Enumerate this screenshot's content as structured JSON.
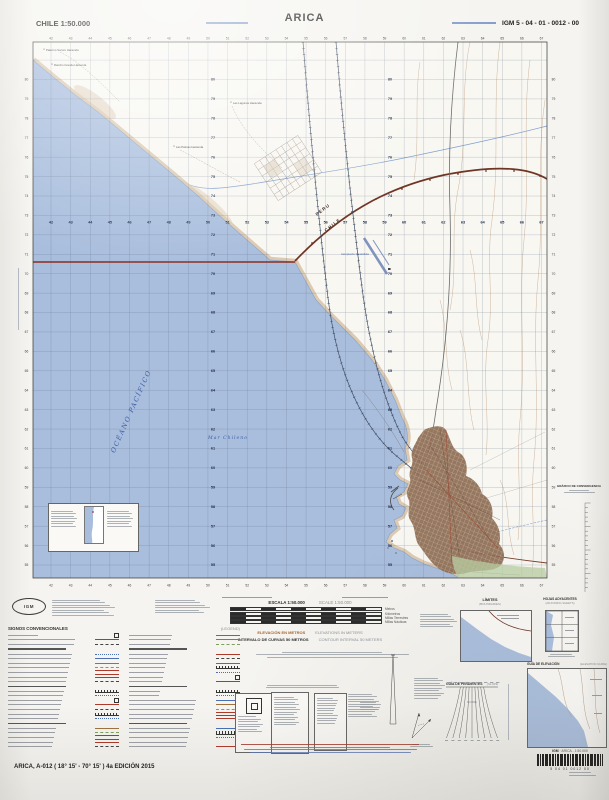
{
  "header": {
    "country_scale": "CHILE  1:50.000",
    "title": "ARICA",
    "sheet_code": "IGM 5 - 04 - 01 - 0012 - 00"
  },
  "map": {
    "labels": {
      "ocean": "OCÉANO   PACÍFICO",
      "sea": "Mar  Chileno",
      "peru": "PERU",
      "chile": "CHILE",
      "airport": "Aeropuerto Chacalluta"
    },
    "haciendas": [
      "Palermo Socoro Hacienda",
      "Rancho Grande Hacienda",
      "Las Lagunas Hacienda",
      "Las Palmas Hacienda"
    ],
    "grid": {
      "eastings": [
        42,
        43,
        44,
        45,
        46,
        47,
        48,
        49,
        50,
        51,
        52,
        53,
        54,
        55,
        56,
        57,
        58,
        59,
        60,
        61,
        62,
        63,
        64,
        65,
        66,
        67
      ],
      "northings": [
        55,
        56,
        57,
        58,
        59,
        60,
        61,
        62,
        63,
        64,
        65,
        66,
        67,
        68,
        69,
        70,
        71,
        72,
        73,
        74,
        75,
        76,
        77,
        78,
        79,
        80
      ]
    },
    "colors": {
      "ocean": "#a9bedd",
      "shore": "#d9c4a8",
      "contour": "#c2a183",
      "border": "#6e3424",
      "maritime_line": "#8c2c20",
      "city": "#8d6b52",
      "water_text": "#3e5ea6"
    }
  },
  "marginalia": {
    "logo": "IGM",
    "scale_block": {
      "escala": "ESCALA 1:50.000",
      "scale": "SCALE 1:50.000",
      "units": [
        "Metros",
        "Kilómetros",
        "Millas Terrestres",
        "Millas Náuticas"
      ]
    },
    "elevation_block": {
      "es1": "ELEVACIÓN EN METROS",
      "en1": "ELEVATIONS IN METERS",
      "es2": "INTERVALO DE CURVAS 50 METROS",
      "en2": "CONTOUR INTERVAL 50 METERS"
    },
    "legend": {
      "title_es": "SIGNOS CONVENCIONALES",
      "title_en": "(LEGEND)"
    },
    "convergence_title": "GRÁFICO DE CONVERGENCIA",
    "limites": {
      "es": "LÍMITES",
      "en": "(BOUNDARIES)"
    },
    "adjoining": {
      "es": "HOJAS ADYACENTES",
      "en": "(ADJOINING SHEETS)"
    },
    "slope": {
      "es": "GUÍA DE PENDIENTES",
      "en": "(SLOPE GUIDE)"
    },
    "elevation_guide": {
      "es": "GUÍA DE ELEVACIÓN",
      "en": "(ELEVATION GUIDE)"
    }
  },
  "footer": {
    "sheet_title": "ARICA, A-012 ( 18° 15' - 70° 15' ) 4a EDICIÓN 2015",
    "barcode_brand": "IGM",
    "barcode_name": "ARICA - 1:50.000",
    "barcode_digits": "5   04   01   0012   00"
  }
}
